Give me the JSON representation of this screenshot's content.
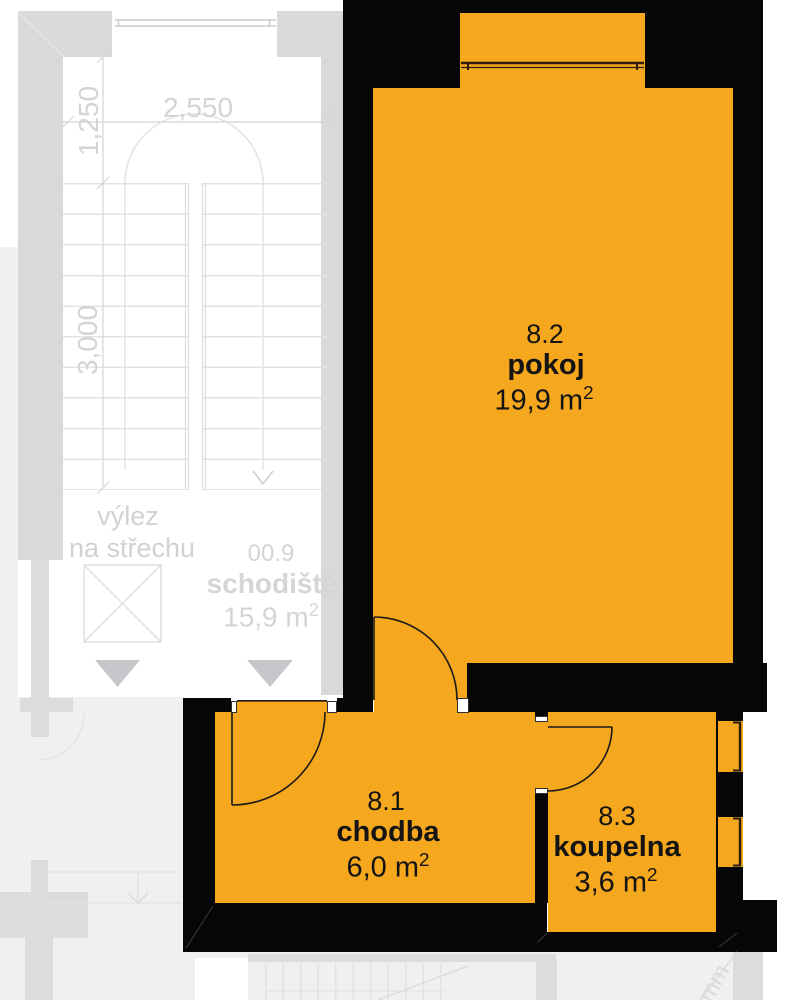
{
  "plan_title": "floor-plan",
  "colors": {
    "room_fill": "#f5a71d",
    "wall": "#060606",
    "stair_wall": "#d9d9db",
    "background_shapes": "#dcdcde",
    "background_area": "#f0f0f1",
    "faint_text": "#d4d4d6",
    "label_text": "#141414"
  },
  "rooms": [
    {
      "id": "8.2",
      "name": "pokoj",
      "area": "19,9 m",
      "area_sup": "2"
    },
    {
      "id": "8.1",
      "name": "chodba",
      "area": "6,0 m",
      "area_sup": "2"
    },
    {
      "id": "8.3",
      "name": "koupelna",
      "area": "3,6 m",
      "area_sup": "2"
    }
  ],
  "staircase": {
    "id": "00.9",
    "name": "schodiště",
    "area": "15,9 m",
    "area_sup": "2",
    "hatch_line1": "výlez",
    "hatch_line2": "na střechu"
  },
  "dimensions": {
    "top_width": "2,550",
    "upper_height": "1,250",
    "lower_height": "3,000",
    "unit_fragment": "mm"
  }
}
